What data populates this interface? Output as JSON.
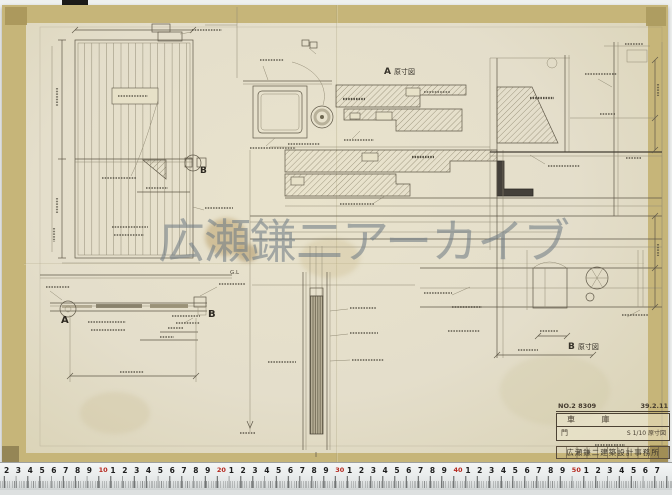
{
  "watermark": {
    "text": "広瀬鎌二アーカイブ"
  },
  "detail_labels": {
    "a_mark": "A",
    "a_caption": "原寸図",
    "b_mark": "B",
    "b_caption": "原寸図",
    "section_left": "A",
    "section_right": "B",
    "elevation_detail_mark": "B",
    "ground_line": "G.L"
  },
  "title_block": {
    "drawing_no": "NO.2 8309",
    "date": "39.2.11",
    "project": "車 庫",
    "sheet": "門",
    "scale": "S 1/10 原寸図",
    "office": "広瀬鎌二建築設計事務所"
  },
  "ruler": {
    "digits": [
      "1",
      "2",
      "3",
      "4",
      "5",
      "6",
      "7",
      "8",
      "9"
    ],
    "decades": [
      "10",
      "20",
      "30",
      "40",
      "50"
    ]
  },
  "colors": {
    "paper": "#e6e0c8",
    "tape_edge": "#c6b579",
    "pencil": "#5f5848",
    "watermark_gray": "rgba(112,124,133,0.58)",
    "ruler_red": "#b5271d"
  }
}
